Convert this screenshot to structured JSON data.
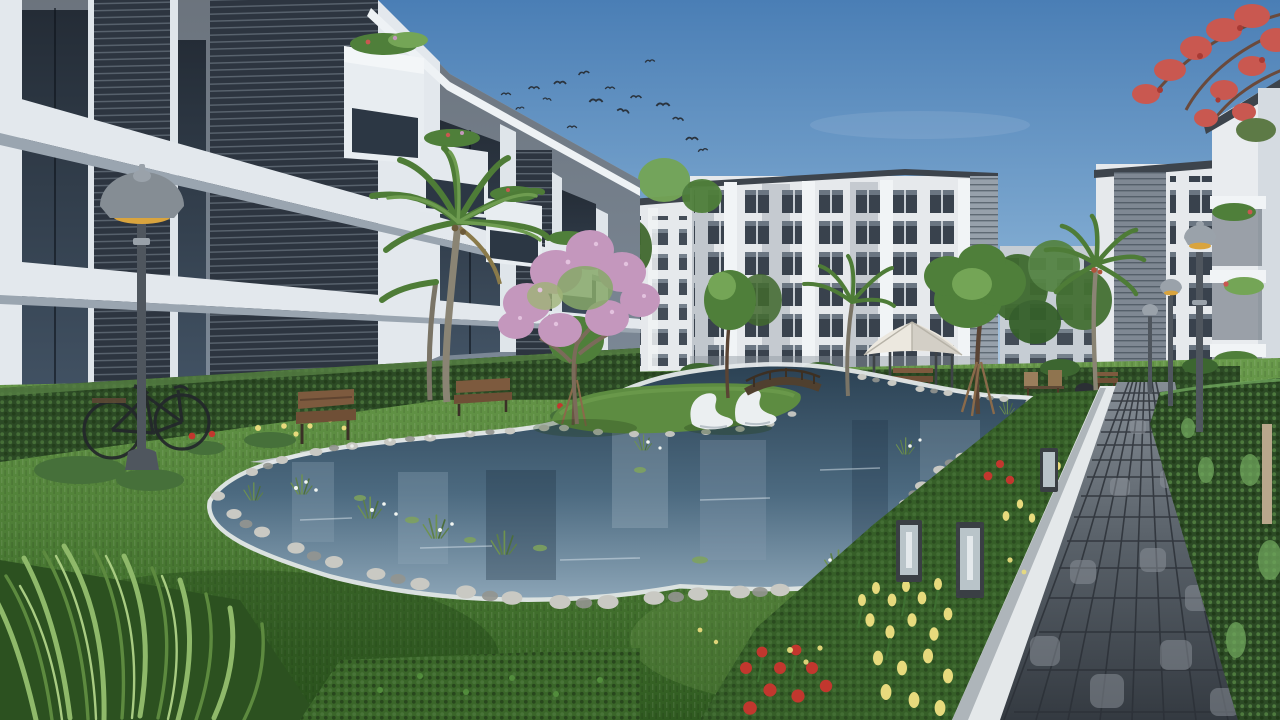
{
  "meta": {
    "kind": "3d-architectural-exterior-rendering",
    "subject": "residential apartment complex courtyard with landscaped pond, lawns and cobblestone walkway",
    "canvas": {
      "width": 1280,
      "height": 720
    }
  },
  "palette": {
    "sky_top": "#4a7eb5",
    "sky_mid": "#7ea9d0",
    "sky_horizon": "#cfe0ee",
    "bird": "#2a333d",
    "bg_wall": "#e6e9ec",
    "bg_wall_shade": "#c6cdd4",
    "bg_stone": "#a9b1b9",
    "bg_roof": "#3d444c",
    "bg_window": "#39424d",
    "bg_louver": "#97a1ab",
    "left_wall": "#cdd5de",
    "left_slab": "#e3e8ed",
    "left_glass_top": "#1c242e",
    "left_glass_bottom": "#3b4c5e",
    "left_navy": "#2d3540",
    "navy_line": "#5a646f",
    "right_wall": "#e9ecef",
    "hedge_dark": "#2c4a25",
    "hedge_light": "#4e7a3e",
    "lawn_light": "#699a4b",
    "lawn_mid": "#4c7c35",
    "lawn_dark": "#2f5a20",
    "fern_green": "#8fb96a",
    "path_light": "#d3d8db",
    "path_shade": "#b9c0c5",
    "curb_white": "#e4e8ea",
    "cobble_light": "#858d95",
    "cobble_mid": "#5b636b",
    "cobble_dark": "#343a41",
    "water_deep": "#2c4254",
    "water_mid": "#4c6a80",
    "water_light": "#8ba4b6",
    "water_sparkle": "#d9e4ec",
    "stone_light": "#c9c9c3",
    "stone_dark": "#939590",
    "island_grass": "#5d8c41",
    "lounger_white": "#ebeff1",
    "wood": "#6f4f36",
    "wood_dark": "#4e3826",
    "canopy_white": "#ece8df",
    "frame_dark": "#3e4347",
    "metal": "#9aa2aa",
    "metal_dark": "#4f565e",
    "lamp_glow": "#d9a43e",
    "blossom_pink": "#c497bd",
    "blossom_red": "#c95850",
    "flower_yellow": "#e7da7d",
    "flower_red": "#c2372e",
    "palm_green": "#4e7c37",
    "tree_green": "#4f7f3a",
    "tree_green_light": "#74a556",
    "trunk_brown": "#6b5544"
  },
  "scene": {
    "sky": {
      "description": "clear blue sky with light haze at horizon",
      "bird_count": 16
    },
    "buildings": {
      "left_foreground": {
        "label": "left apartment block",
        "stories_visible": "4-5",
        "facade": "white concrete piers, dark glazing, navy louver panels, protruding balconies with planters"
      },
      "center_background": {
        "label": "center apartment block",
        "stories_visible": 7
      },
      "right_background": {
        "label": "right apartment block with louvered core",
        "stories_visible": 7
      },
      "right_edge": {
        "label": "near building at right edge with planted balconies"
      }
    },
    "courtyard": {
      "pond": {
        "label": "organic-shaped pond with white curb, stone rim and aquatic plants"
      },
      "island": {
        "label": "grass island",
        "lounger_count": 2
      },
      "bridge": {
        "label": "small wooden foot bridge"
      },
      "gazebo": {
        "label": "white canvas gazebo with bench"
      },
      "walkway": {
        "label": "dark cobblestone walkway receding along right side"
      },
      "flower_beds": {
        "yellow": "tulips",
        "red": "poppies and roses",
        "pink": "blossom tree"
      },
      "hedges": {
        "left": "clipped hedge below left building",
        "right": "tall hedge wall along walkway"
      },
      "furniture": [
        "wooden benches",
        "garden chairs",
        "barbecue grill"
      ],
      "lighting": {
        "street_lamps": 4,
        "bollard_lights": 3
      },
      "bicycle": "classic bicycle leaning on left hedge",
      "trees": [
        "coconut palms",
        "pink blossom tree",
        "staked young trees",
        "red flowering branches top right"
      ]
    }
  }
}
